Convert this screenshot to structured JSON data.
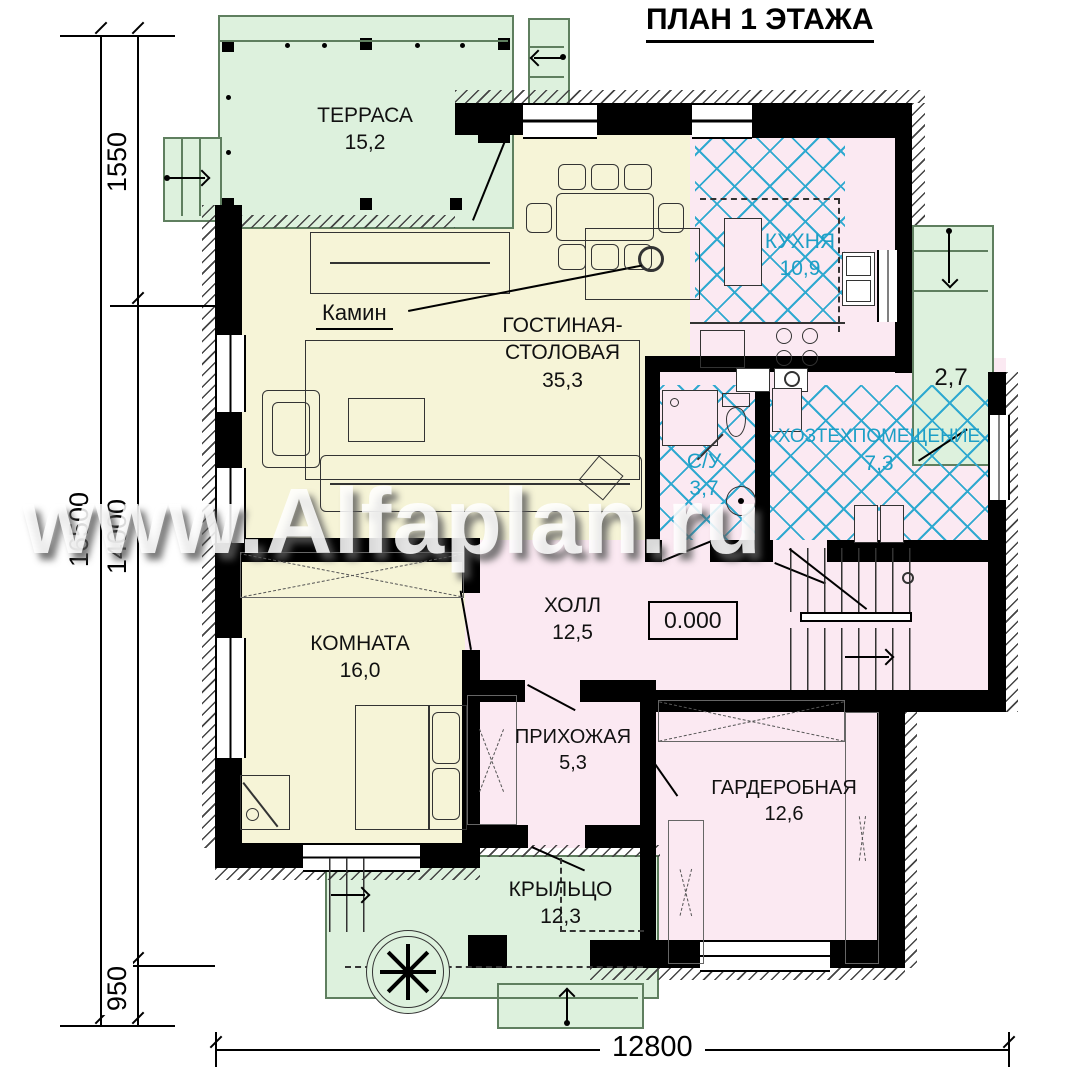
{
  "title": "ПЛАН 1 ЭТАЖА",
  "watermark": "www.Alfaplan.ru",
  "rooms": {
    "terrace": {
      "name": "ТЕРРАСА",
      "area": "15,2"
    },
    "living": {
      "name_line1": "ГОСТИНАЯ-",
      "name_line2": "СТОЛОВАЯ",
      "area": "35,3"
    },
    "kitchen": {
      "name": "КУХНЯ",
      "area": "10,9"
    },
    "side_entry": {
      "area": "2,7"
    },
    "bathroom": {
      "name": "С/У",
      "area": "3,7"
    },
    "utility": {
      "name": "ХОЗТЕХПОМЕЩЕНИЕ",
      "area": "7,3"
    },
    "hall": {
      "name": "ХОЛЛ",
      "area": "12,5"
    },
    "room": {
      "name": "КОМНАТА",
      "area": "16,0"
    },
    "entrance_hall": {
      "name": "ПРИХОЖАЯ",
      "area": "5,3"
    },
    "dressing": {
      "name": "ГАРДЕРОБНАЯ",
      "area": "12,6"
    },
    "porch": {
      "name": "КРЫЛЬЦО",
      "area": "12,3"
    }
  },
  "annotations": {
    "fireplace": "Камин",
    "elevation_mark": "0.000"
  },
  "dimensions": {
    "left_offset_top": "1550",
    "left_total": "16500",
    "left_main": "14000",
    "left_offset_bottom": "950",
    "bottom_width": "12800"
  },
  "colors": {
    "terrace_fill": "#ddf1dd",
    "living_fill": "#f6f4d7",
    "service_fill": "#fbe9f2",
    "crosshatch_blue": "#2fa9d0",
    "label_blue": "#1d9fc6",
    "wall": "#000000"
  }
}
